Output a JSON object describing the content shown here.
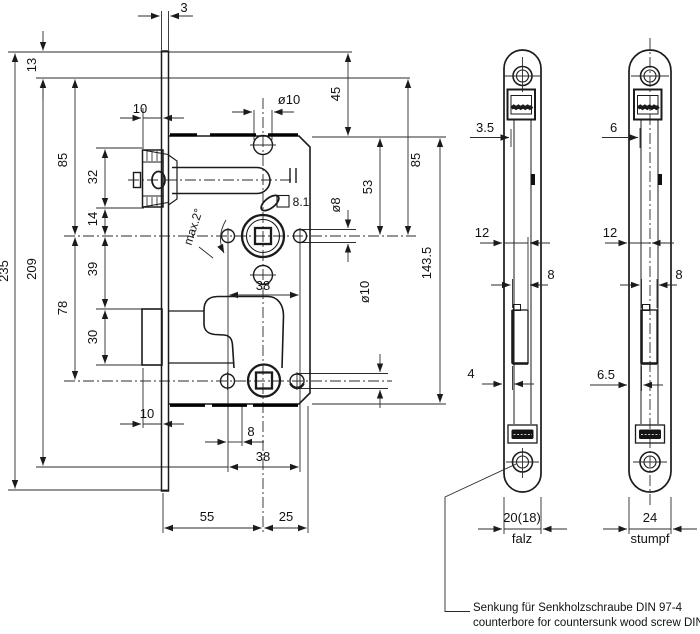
{
  "drawing_title": "mortise lock technical drawing",
  "d": {
    "t3": "3",
    "t13": "13",
    "t45": "45",
    "t85l": "85",
    "t85r": "85",
    "t10t": "10",
    "t32": "32",
    "tdia10t": "ø10",
    "t53": "53",
    "t81": "8.1",
    "tdia8": "ø8",
    "tmax": "max.2°",
    "t14": "14",
    "t39": "39",
    "t209": "209",
    "t235": "235",
    "t78": "78",
    "t30": "30",
    "t38u": "38",
    "tdia10b": "ø10",
    "t1435": "143.5",
    "t10b": "10",
    "t8b": "8",
    "t38b": "38",
    "t55": "55",
    "t25": "25"
  },
  "p1": {
    "t35": "3.5",
    "t12": "12",
    "t8": "8",
    "t4": "4",
    "tw": "20(18)",
    "tlbl": "falz"
  },
  "p2": {
    "t6": "6",
    "t12": "12",
    "t8": "8",
    "t65": "6.5",
    "tw": "24",
    "tlbl": "stumpf"
  },
  "note": {
    "de": "Senkung für Senkholzschraube DIN 97-4",
    "en": "counterbore for countersunk wood screw DIN 97-4"
  }
}
